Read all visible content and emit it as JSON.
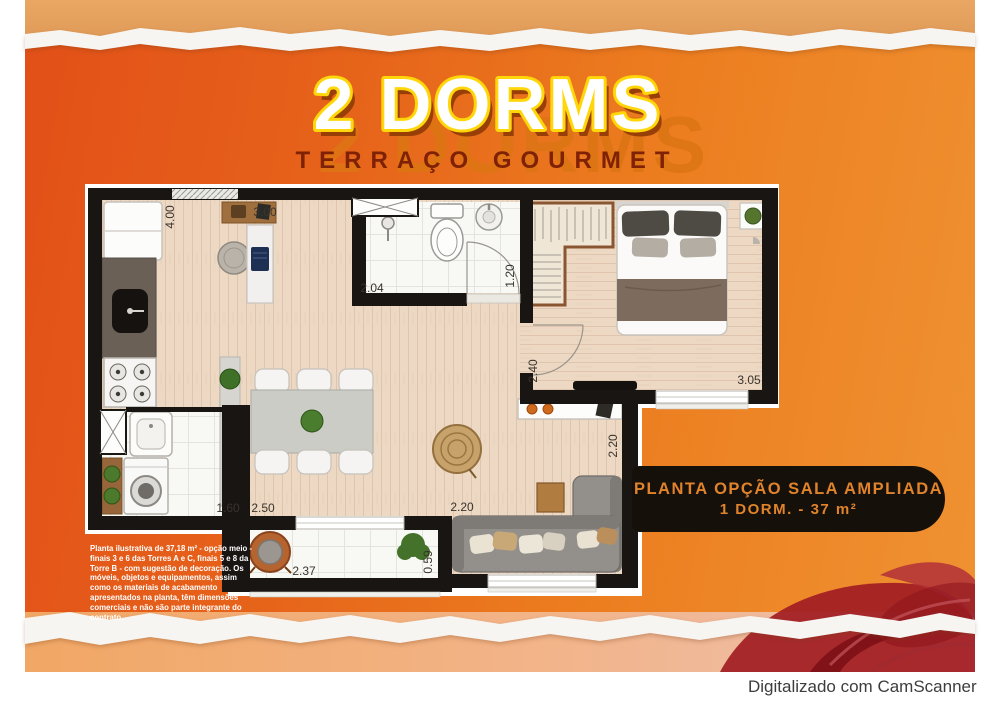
{
  "poster": {
    "title": "2 DORMS",
    "subtitle": "TERRAÇO GOURMET",
    "badge": {
      "line1": "PLANTA OPÇÃO SALA AMPLIADA",
      "line2": "1 DORM. - 37 m²"
    },
    "disclaimer": "Planta ilustrativa de 37,18 m² - opção meio - finais 3 e 6 das Torres A e C, finais 5 e 8 da Torre B - com sugestão de decoração. Os móveis, objetos e equipamentos, assim como os materiais de acabamento apresentados na planta, têm dimensões comerciais e não são parte integrante do contrato."
  },
  "dimensions": {
    "kitchen_depth": "4.00",
    "living_width": "3.00",
    "bathroom_width": "2.04",
    "bathroom_depth": "1.20",
    "bedroom_entry_depth": "2.40",
    "bedroom_width": "3.05",
    "laundry_width": "1.60",
    "dining_width": "2.50",
    "sofa_area_width": "2.20",
    "living_side_depth": "2.20",
    "terrace_width": "2.37",
    "terrace_depth": "0.59"
  },
  "footer": {
    "scanner": "Digitalizado com CamScanner"
  },
  "colors": {
    "poster_orange": "#e8681b",
    "title_fill": "#ffffff",
    "title_outline": "#ffd60a",
    "subtitle_color": "#7e2104",
    "badge_bg": "#16100b",
    "badge_text": "#e0832b",
    "wall_black": "#191513",
    "wood_floor": "#ecd8c3",
    "swirl_red": "#a11c22"
  }
}
